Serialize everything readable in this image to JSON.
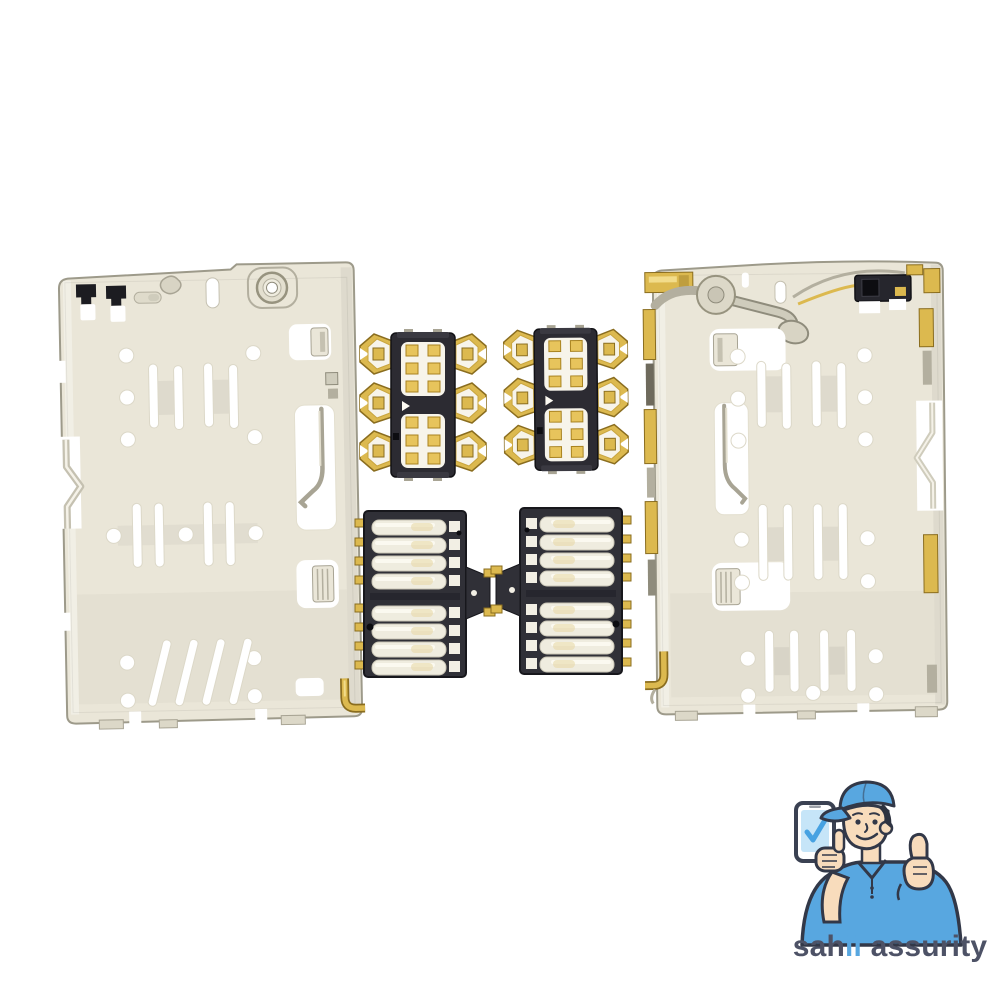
{
  "photo": {
    "background": "#ffffff",
    "subject": "SIM card reader tray shields and spring contact connector modules"
  },
  "brand": {
    "wordmark_part1": "sah",
    "wordmark_accent": "ii",
    "wordmark_part2": " assurity",
    "full_name": "sahii assurity"
  },
  "icons": {
    "mascot": "technician-with-cap-phone-thumbs-up",
    "phone_screen": "checkmark-icon"
  },
  "colors": {
    "metal": "#eae6d8",
    "metal-edge": "#9d9a8a",
    "metal-mid": "#d8d4c4",
    "metal-dark": "#b3af9f",
    "metal-deep": "#8f8c7c",
    "gold": "#dcb94f",
    "gold-light": "#f2dc8a",
    "gold-dark": "#8a6d1f",
    "plastic": "#303037",
    "plastic-dark": "#17171c",
    "spring": "#efecdf",
    "spring-edge": "#c9c5b5",
    "pad-gold": "#e7c45c",
    "brand-blue": "#58a7e0",
    "brand-navy": "#323848",
    "brand-text": "#4d5266",
    "screen": "#c6e5f8",
    "check": "#47a2e2",
    "skin": "#f8dcbc",
    "bg": "#ffffff"
  }
}
